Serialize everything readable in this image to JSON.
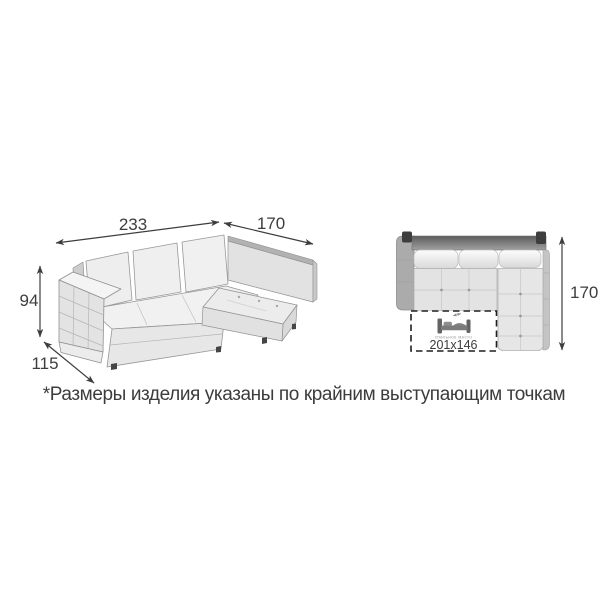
{
  "perspective_view": {
    "dim_width": "233",
    "dim_chaise": "170",
    "dim_height": "94",
    "dim_depth": "115"
  },
  "top_view": {
    "dim_depth": "170",
    "sleeping_area": {
      "size": "201x146",
      "caption": "спальное место",
      "icon": "bed-icon"
    }
  },
  "footnote": "*Размеры изделия указаны по крайним выступающим точкам",
  "colors": {
    "dimension_line": "#3d3d3d",
    "sofa_light": "#ececec",
    "sofa_mid": "#ababab",
    "back_bar_dark": "#3e3e3e",
    "background": "#ffffff"
  }
}
